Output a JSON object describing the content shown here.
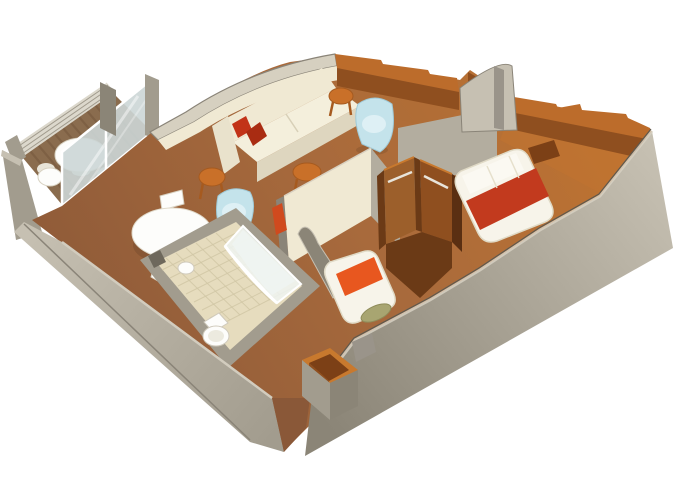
{
  "meta": {
    "title": "3D isometric cruise-cabin floor plan rendering",
    "view": "cutaway axonometric, white background, no text"
  },
  "scene": {
    "rooms": [
      {
        "id": "balcony",
        "label": "Balcony",
        "furniture": [
          "round-table",
          "deck-chairs",
          "glass-railing",
          "sliding-glass-door",
          "plank-decking"
        ]
      },
      {
        "id": "living-room",
        "label": "Living Room",
        "furniture": [
          "cream-sofa",
          "red-throw-pillows",
          "blue-tub-chair",
          "orange-stools",
          "brown-sideboard"
        ]
      },
      {
        "id": "dining-area",
        "label": "Dining Area",
        "furniture": [
          "round-dining-table",
          "white-chairs",
          "blue-tub-chair"
        ]
      },
      {
        "id": "bathroom",
        "label": "Bathroom",
        "furniture": [
          "curved-glass-shower",
          "toilet",
          "sink",
          "tiled-floor"
        ]
      },
      {
        "id": "middle-bedroom",
        "label": "Second Bedroom",
        "furniture": [
          "single-bed-orange-runner",
          "olive-bolster",
          "open-wardrobe"
        ]
      },
      {
        "id": "main-bedroom",
        "label": "Main Bedroom",
        "furniture": [
          "double-bed-red-runner",
          "headboard",
          "stepped-brown-wall"
        ]
      },
      {
        "id": "entrance",
        "label": "Entrance",
        "furniture": [
          "storage-box"
        ]
      }
    ]
  },
  "palette": {
    "bg": "#ffffff",
    "wallGray": "#a29c8e",
    "wallGrayLight": "#c6c0b2",
    "wallGrayMid": "#9a948a",
    "wallGrayDark": "#6e685c",
    "wallOlive": "#8b8577",
    "wallFaceLight": "#b3ad9f",
    "cream": "#f0e9d3",
    "creamShadow": "#ded6bf",
    "creamEdge": "#d6d0c0",
    "floorDark": "#8a5838",
    "floorMid": "#a86a3c",
    "floorOrange": "#c1742f",
    "brownTop": "#bc6c2b",
    "brownFace": "#8f4f1f",
    "woodDark": "#6b3a16",
    "woodMid": "#9c5f2b",
    "woodDeep": "#5a2f12",
    "woodLight": "#c8792e",
    "cavity": "#7c4016",
    "bedWhite": "#f7f4ea",
    "bedTrim": "#e0dac6",
    "red": "#c23a1e",
    "redDark": "#a92c12",
    "pillowRed": "#c23318",
    "orange": "#e8571f",
    "olive": "#a8a571",
    "oliveEdge": "#8f8c5a",
    "blue": "#c4e3eb",
    "blueLight": "#def0f5",
    "stool": "#c97029",
    "stoolDark": "#a65a1f",
    "glass": "#ccd6d6",
    "glassPane": "#eff4f2",
    "tile": "#e6dcbe",
    "tileLine": "#cfc5a4",
    "white": "#fdfdfb",
    "whiteShade": "#e8e4d8",
    "deck": "#8a6c4e",
    "deckStripe": "#75583c",
    "railLight": "#dcd8cc",
    "railLine": "#a09a8c"
  }
}
